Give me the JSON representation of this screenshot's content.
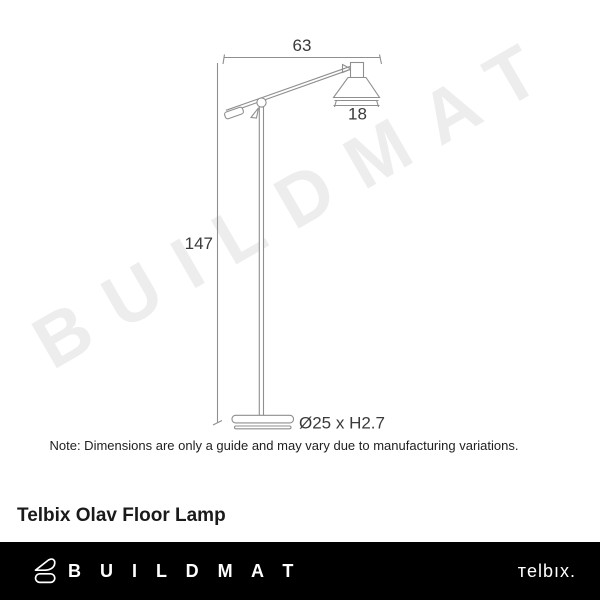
{
  "watermark": {
    "text": "BUILDMAT",
    "color": "#ededed"
  },
  "diagram": {
    "type": "product-dimension-line-drawing",
    "product": "floor lamp",
    "stroke_color": "#8f8f8f",
    "dim_text_color": "#3a3a3a",
    "dimensions": {
      "arm_width": "63",
      "shade_width": "18",
      "height": "147",
      "base": "Ø25 x H2.7"
    }
  },
  "note": {
    "text": "Note: Dimensions are only a guide and may vary due to manufacturing variations."
  },
  "title": {
    "text": "Telbix Olav Floor Lamp"
  },
  "footer": {
    "background": "#000000",
    "buildmat_wordmark": "B U I L D M A T",
    "telbix_logo": "тelbıx."
  }
}
